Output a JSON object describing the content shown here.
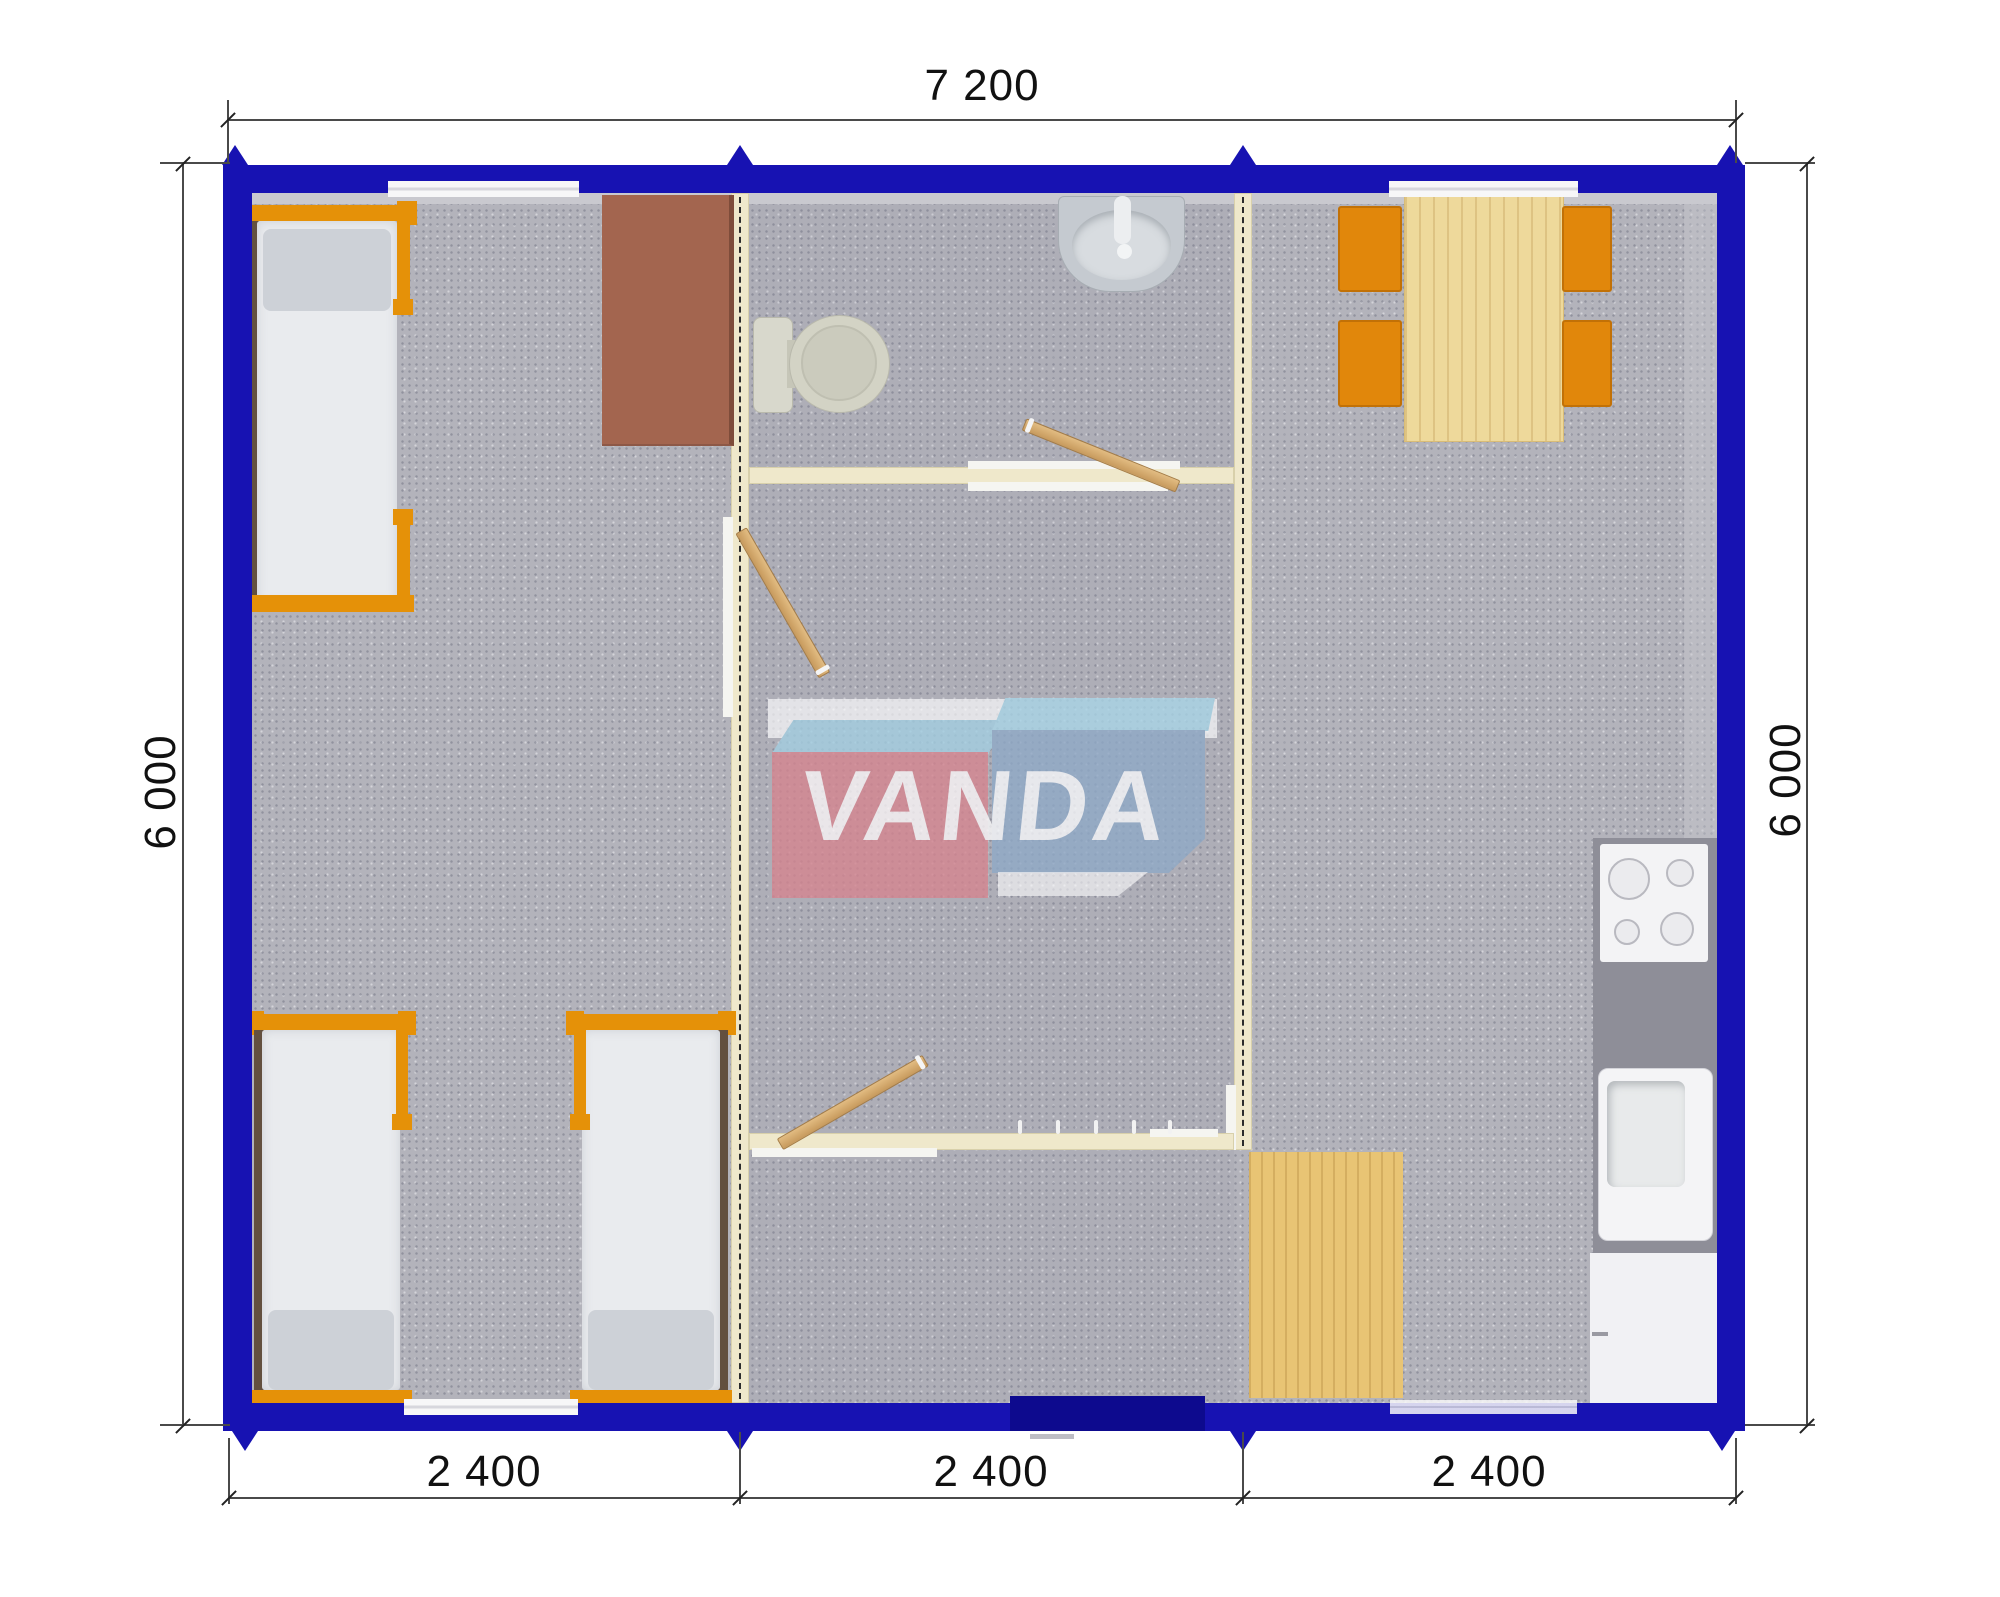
{
  "title": "Modular container building floor plan 7200 x 6000",
  "watermark": {
    "brand": "VANDA"
  },
  "dimensions": {
    "top": {
      "label": "7 200"
    },
    "left": {
      "label": "6 000"
    },
    "right": {
      "label": "6 000"
    },
    "bottom": [
      {
        "label": "2 400"
      },
      {
        "label": "2 400"
      },
      {
        "label": "2 400"
      }
    ]
  },
  "colors": {
    "exterior_wall": "#1712b2",
    "entrance_door": "#0d0a8e",
    "partition_wall": "#efe8cb",
    "furniture_accent_orange": "#e59108",
    "floor_carpet": "#b3b3bb",
    "wood_light": "#eed99b",
    "desk_brown": "#a3654f",
    "logo_red": "#d6848f",
    "logo_steel_blue": "#8fa9c7",
    "logo_light_blue": "#a3cfe2"
  },
  "modules": {
    "left": {
      "contents": [
        "single bed",
        "desk",
        "single bed",
        "single bed"
      ]
    },
    "middle": {
      "contents": [
        "washbasin",
        "toilet",
        "hallway",
        "entrance hall with coat hooks"
      ]
    },
    "right": {
      "contents": [
        "dining table",
        "four chairs",
        "cooktop",
        "kitchen sink",
        "kitchen cabinet",
        "low wooden table"
      ]
    }
  }
}
